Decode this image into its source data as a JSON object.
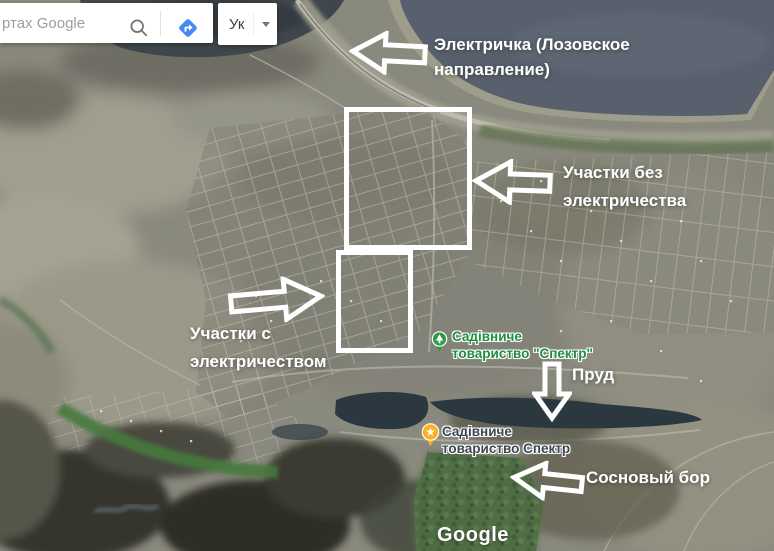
{
  "search_bar": {
    "placeholder": "ртах Google"
  },
  "profile_button": {
    "label": "Ук"
  },
  "annotations": {
    "train": {
      "line1": "Электричка (Лозовское",
      "line2": "направление)"
    },
    "no_electricity": {
      "line1": "Участки без",
      "line2": "электричества"
    },
    "with_electricity": {
      "line1": "Участки с",
      "line2": "электричеством"
    },
    "pond": {
      "label": "Пруд"
    },
    "pine_forest": {
      "label": "Сосновый бор"
    }
  },
  "poi": {
    "green": {
      "line1": "Садівниче",
      "line2": "товариство \"Спектр\""
    },
    "yellow": {
      "line1": "Садівниче",
      "line2": "товариство Спектр"
    }
  },
  "watermark": {
    "label": "Google"
  },
  "icons": {
    "search": "magnifier-icon",
    "directions": "directions-diamond-icon",
    "dropdown": "chevron-down-icon",
    "green_poi": "tree-pin-icon",
    "yellow_poi": "star-pin-icon"
  },
  "colors": {
    "directions_blue": "#4688f4",
    "poi_green_pin": "#2e9c45",
    "poi_green_label": "#1e8e3e",
    "poi_yellow_pin": "#f9b023",
    "poi_yellow_label": "#3c4752",
    "lake_water": "#57606c",
    "annotation_white": "#ffffff"
  }
}
